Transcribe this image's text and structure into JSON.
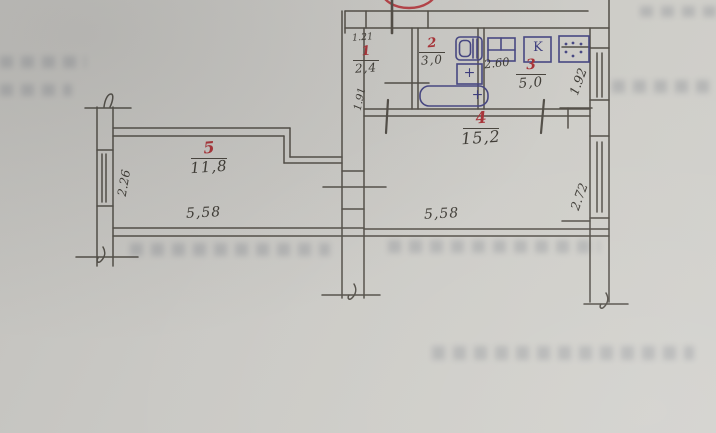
{
  "plan": {
    "rooms": [
      {
        "number": "1",
        "area": "2,4"
      },
      {
        "number": "2",
        "area": "3,0"
      },
      {
        "number": "3",
        "area": "5,0"
      },
      {
        "number": "4",
        "area": "15,2"
      },
      {
        "number": "5",
        "area": "11,8"
      }
    ],
    "dims": {
      "hall_depth": "1.21",
      "hall_width": "1.91",
      "kitchen_width": "2.60",
      "kitchen_window": "1.92",
      "room4_width": "5,58",
      "room4_window": "2.72",
      "room5_width": "5,58",
      "room5_window": "2.26"
    },
    "fixtures": {
      "cupboard_letter": "K",
      "sink_tap": "+",
      "bath_tap": "+"
    },
    "colors": {
      "paper": "#c9c8c4",
      "pencil": "#48443d",
      "red": "#a93338",
      "blue": "#3d3d7e"
    }
  }
}
